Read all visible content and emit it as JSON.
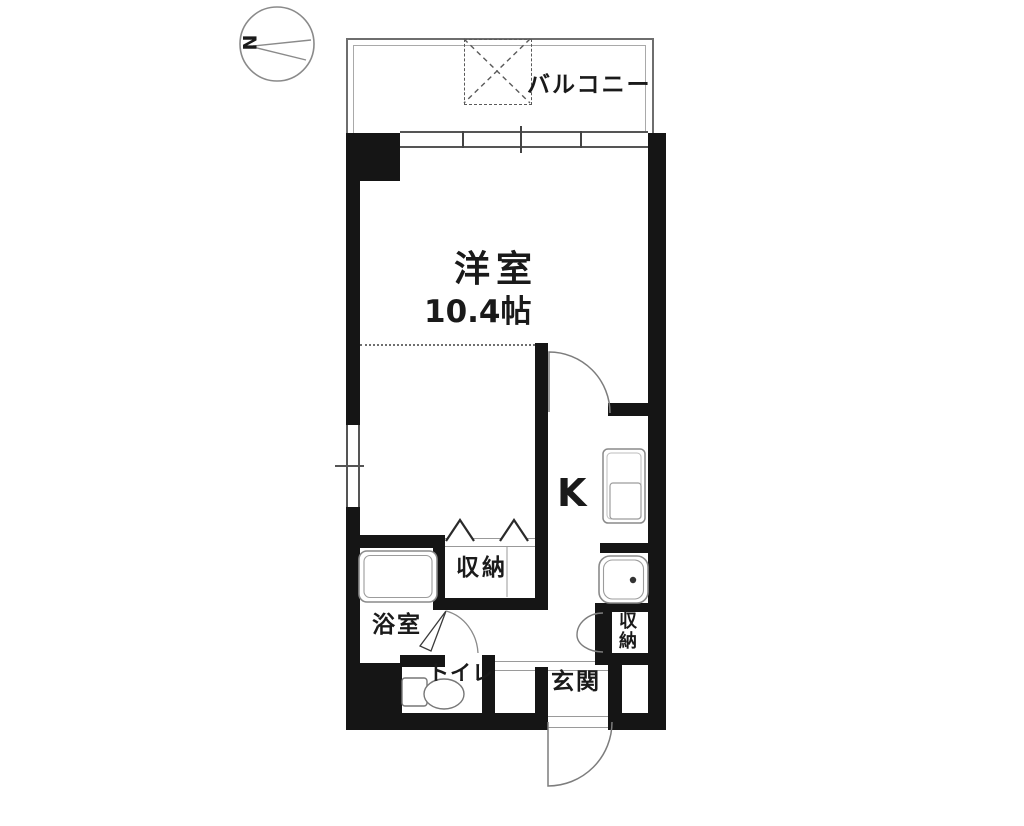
{
  "compass": {
    "north_label": "N"
  },
  "labels": {
    "balcony": "バルコニー",
    "main_room_name": "洋室",
    "main_room_size": "10.4帖",
    "kitchen": "K",
    "closet_center": "収納",
    "closet_entry": "収納",
    "bathroom": "浴室",
    "toilet": "トイレ",
    "entrance": "玄関"
  },
  "colors": {
    "wall": "#151515",
    "thin_line": "#777777",
    "fixture_line": "#8a8a8a",
    "text": "#1a1a1a",
    "background": "#ffffff"
  }
}
